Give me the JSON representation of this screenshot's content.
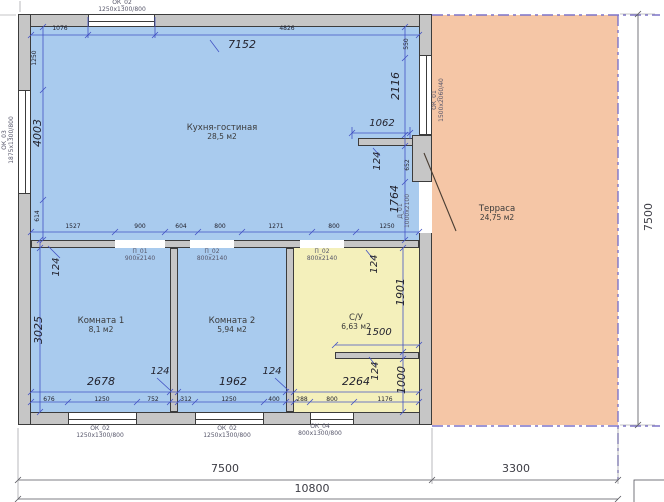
{
  "rooms": {
    "kitchen": {
      "name": "Кухня-гостиная",
      "area": "28,5 м2"
    },
    "room1": {
      "name": "Комната 1",
      "area": "8,1 м2"
    },
    "room2": {
      "name": "Комната 2",
      "area": "5,94 м2"
    },
    "bathroom": {
      "name": "С/У",
      "area": "6,63 м2"
    },
    "terrace": {
      "name": "Терраса",
      "area": "24,75 м2"
    }
  },
  "windows": {
    "ok02_top": {
      "code": "ОК_02",
      "size": "1250х1300/800"
    },
    "ok03_left": {
      "code": "ОК_03",
      "size": "1875х1300/800"
    },
    "ok01_right": {
      "code": "ОК_01",
      "size": "1500х2060/40"
    },
    "ok02_b1": {
      "code": "ОК_02",
      "size": "1250х1300/800"
    },
    "ok02_b2": {
      "code": "ОК_02",
      "size": "1250х1300/800"
    },
    "ok04_b3": {
      "code": "ОК_04",
      "size": "800х1300/800"
    }
  },
  "doors": {
    "d01": {
      "code": "Д_01",
      "size": "1000х2100"
    },
    "p01": {
      "code": "П_01",
      "size": "900х2140"
    },
    "p02a": {
      "code": "П_02",
      "size": "800х2140"
    },
    "p02b": {
      "code": "П_02",
      "size": "800х2140"
    }
  },
  "dims": {
    "overall": {
      "house_width": "7500",
      "terrace_width": "3300",
      "total_width": "10800",
      "height": "7500"
    },
    "kitchen": {
      "top_left": "1076",
      "top_right": "4826",
      "width_note": "7152",
      "left": [
        "1250",
        "4003",
        "614"
      ],
      "right_top": "550",
      "right": [
        "2116",
        "1062",
        "124",
        "652",
        "1764"
      ],
      "bottom_chain": [
        "1527",
        "900",
        "604",
        "800",
        "1271",
        "800",
        "1250"
      ]
    },
    "room1": {
      "wall_top": "124",
      "height": "3025",
      "width": "2678",
      "wall_right": "124",
      "bottom_chain": [
        "676",
        "1250",
        "752"
      ]
    },
    "room2": {
      "width": "1962",
      "wall_right": "124",
      "bottom_chain": [
        "312",
        "1250",
        "400"
      ]
    },
    "bathroom": {
      "wall_top": "124",
      "upper_height": "1901",
      "stub_width": "1500",
      "wall_mid": "124",
      "lower_height": "1000",
      "width": "2264",
      "bottom_chain": [
        "288",
        "800",
        "1176"
      ]
    }
  },
  "colors": {
    "room_fill": "#a9cbee",
    "bathroom_fill": "#f4f0bb",
    "terrace_fill": "#f5c6a6",
    "wall": "#c6c6c6",
    "dim_line": "#4353c4",
    "terrace_border": "#7d74c9"
  }
}
